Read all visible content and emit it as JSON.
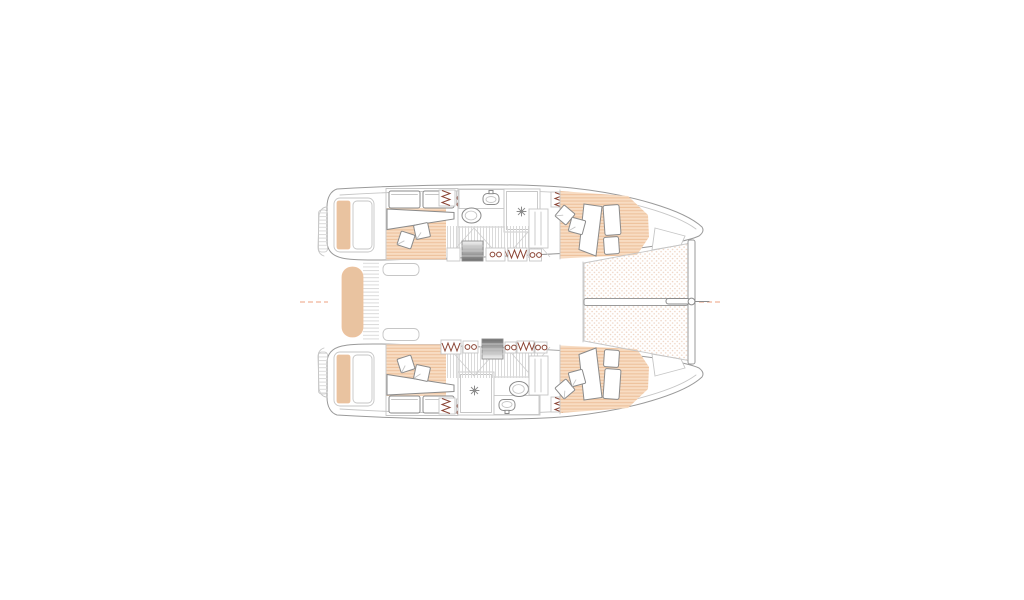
{
  "canvas": {
    "width": 1024,
    "height": 600,
    "background": "#ffffff"
  },
  "colors": {
    "paper": "#ffffff",
    "outline": "#9a9a9a",
    "outline-light": "#c6c6c6",
    "fixture": "#8b8b8b",
    "hatch": "#dadada",
    "floor": "#f8dcc2",
    "floor-stripe": "#eec29d",
    "peach-solid": "#e9c3a0",
    "tramp-dot": "#eed4c3",
    "centerline": "#f0b49b",
    "maroon": "#8a4434",
    "stairs-light": "#f2f2f2",
    "stairs-dark": "#6f6f6f"
  },
  "diagram": {
    "type": "floorplan",
    "subject": "catamaran yacht lower-deck accommodation plan, top view, bow to the right",
    "hulls": [
      {
        "name": "port hull (top)",
        "rooms": [
          "aft double cabin",
          "bathroom: toilet, washbasin, shower",
          "corridor",
          "forward double cabin"
        ]
      },
      {
        "name": "starboard hull (bottom)",
        "rooms": [
          "aft double cabin",
          "bathroom: shower, washbasin, toilet",
          "corridor",
          "forward double cabin"
        ]
      }
    ],
    "shared_features": [
      "transom platforms with peach steps",
      "outboard molded steps",
      "cockpit bench",
      "boarding steps between transoms",
      "bridge-deck saloon area (open)",
      "bow trampoline with central walkway",
      "forward crossbeam",
      "bowsprit with bridle lines",
      "hanging lockers",
      "companionway stairs",
      "dashed centerline"
    ]
  }
}
